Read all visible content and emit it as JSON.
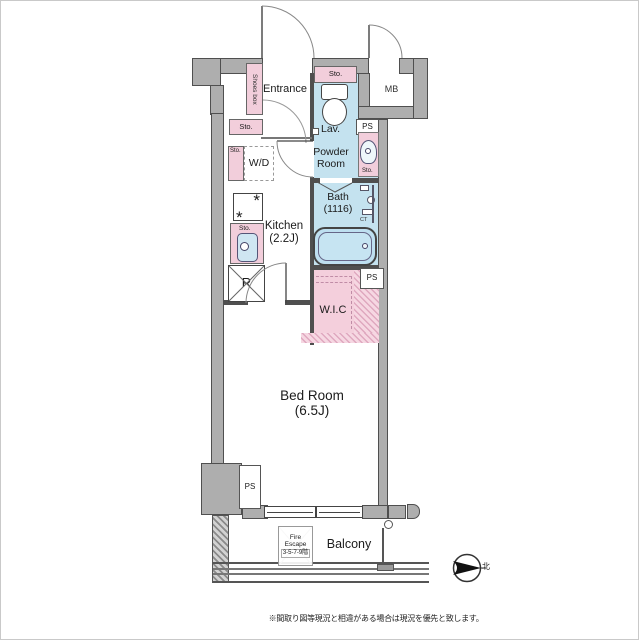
{
  "floorplan": {
    "rooms": {
      "entrance": "Entrance",
      "kitchen_name": "Kitchen",
      "kitchen_size": "(2.2J)",
      "powder_line1": "Powder",
      "powder_line2": "Room",
      "lav": "Lav.",
      "bath_name": "Bath",
      "bath_size": "(1116)",
      "wic": "W.I.C",
      "bedroom_name": "Bed Room",
      "bedroom_size": "(6.5J)",
      "balcony": "Balcony"
    },
    "labels": {
      "sto": "Sto.",
      "ps": "PS"
    },
    "utility": {
      "mb": "MB"
    },
    "fixtures": {
      "shoes_box": "Shoes box",
      "washer_dryer": "W/D",
      "refrigerator": "R",
      "counter": "CT",
      "burner_glyph": "*"
    },
    "fire_escape": {
      "line1": "Fire",
      "line2": "Escape",
      "line3": "3-5-7-9階"
    },
    "compass": {
      "north": "北"
    },
    "note": "※間取り図等現況と相違がある場合は現況を優先と致します。",
    "colors": {
      "wet_area_blue": "#c4e2ef",
      "storage_pink": "#f2cedb",
      "wall_gray": "#aeaeae"
    }
  }
}
